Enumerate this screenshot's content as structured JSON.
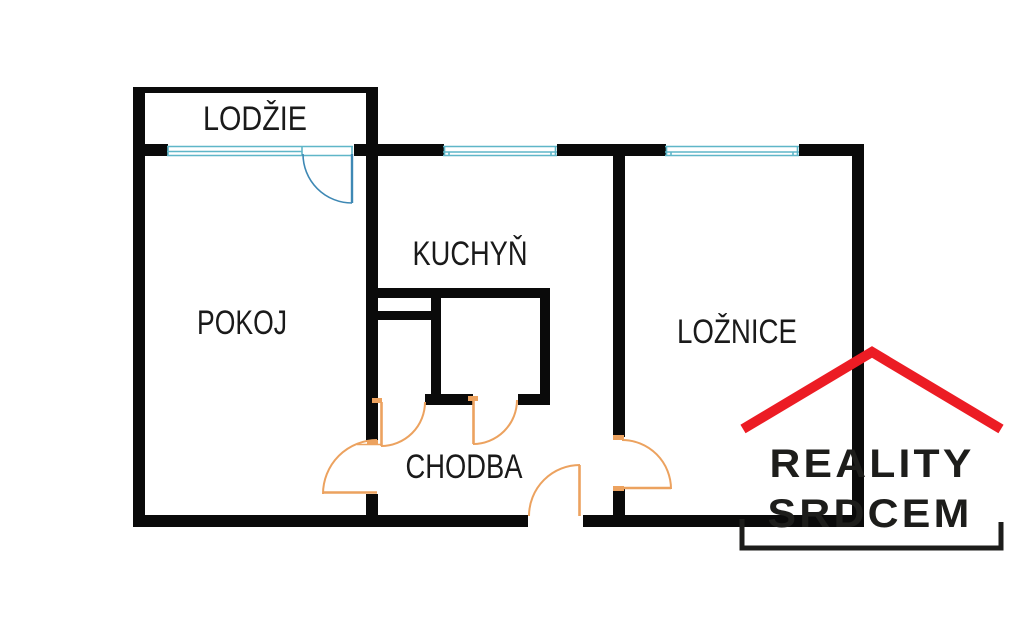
{
  "page": {
    "background": "#ffffff",
    "width": 1024,
    "height": 621
  },
  "floorplan": {
    "rooms": [
      {
        "id": "lodzie",
        "label": "LODŽIE"
      },
      {
        "id": "pokoj",
        "label": "POKOJ"
      },
      {
        "id": "kuchyn",
        "label": "KUCHYŇ"
      },
      {
        "id": "loznice",
        "label": "LOŽNICE"
      },
      {
        "id": "chodba",
        "label": "CHODBA"
      }
    ],
    "features": {
      "windows": [
        "loggia-window",
        "kitchen-window",
        "bedroom-window"
      ],
      "doors": [
        "balcony-door",
        "pokoj-door",
        "kitchen-door",
        "bathroom-door",
        "bedroom-door",
        "entrance-door"
      ]
    },
    "colors": {
      "wall": "#0a0a0a",
      "window": "#5fb6c8",
      "balcony_door": "#3e88b4",
      "interior_door": "#eca25f"
    }
  },
  "logo": {
    "line1": "REALITY",
    "line2": "SRDCEM",
    "roof_color": "#ec1c24",
    "text_color": "#1d1d1b"
  }
}
